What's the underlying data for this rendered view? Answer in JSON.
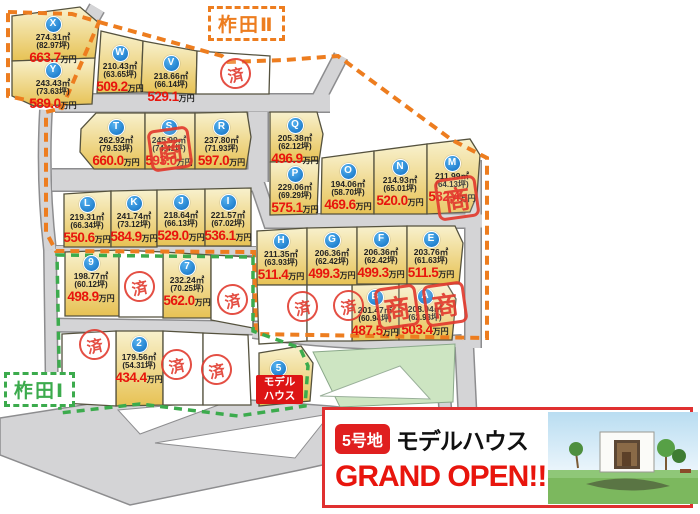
{
  "region_labels": {
    "kakita_2": "柞田Ⅱ",
    "kakita_1": "柞田Ⅰ"
  },
  "price_unit": "万円",
  "stamp_sold": "済",
  "stamp_deal": "商",
  "lots": [
    {
      "id": "X",
      "area": "274.31㎡",
      "tsubo": "(82.97坪)",
      "price": "663.7"
    },
    {
      "id": "Y",
      "area": "243.43㎡",
      "tsubo": "(73.63坪)",
      "price": "589.0"
    },
    {
      "id": "W",
      "area": "210.43㎡",
      "tsubo": "(63.65坪)",
      "price": "509.2"
    },
    {
      "id": "V",
      "area": "218.66㎡",
      "tsubo": "(66.14坪)",
      "price": "529.1"
    },
    {
      "id": "T",
      "area": "262.92㎡",
      "tsubo": "(79.53坪)",
      "price": "660.0"
    },
    {
      "id": "S",
      "area": "245.99㎡",
      "tsubo": "(74.41坪)",
      "price": "593.0"
    },
    {
      "id": "R",
      "area": "237.80㎡",
      "tsubo": "(71.93坪)",
      "price": "597.0"
    },
    {
      "id": "Q",
      "area": "205.38㎡",
      "tsubo": "(62.12坪)",
      "price": "496.9"
    },
    {
      "id": "P",
      "area": "229.06㎡",
      "tsubo": "(69.29坪)",
      "price": "575.1"
    },
    {
      "id": "O",
      "area": "194.06㎡",
      "tsubo": "(58.70坪)",
      "price": "469.6"
    },
    {
      "id": "N",
      "area": "214.93㎡",
      "tsubo": "(65.01坪)",
      "price": "520.0"
    },
    {
      "id": "M",
      "area": "211.99㎡",
      "tsubo": "(64.13坪)",
      "price": "532.4"
    },
    {
      "id": "L",
      "area": "219.31㎡",
      "tsubo": "(66.34坪)",
      "price": "550.6"
    },
    {
      "id": "K",
      "area": "241.74㎡",
      "tsubo": "(73.12坪)",
      "price": "584.9"
    },
    {
      "id": "J",
      "area": "218.64㎡",
      "tsubo": "(66.13坪)",
      "price": "529.0"
    },
    {
      "id": "I",
      "area": "221.57㎡",
      "tsubo": "(67.02坪)",
      "price": "536.1"
    },
    {
      "id": "H",
      "area": "211.35㎡",
      "tsubo": "(63.93坪)",
      "price": "511.4"
    },
    {
      "id": "G",
      "area": "206.36㎡",
      "tsubo": "(62.42坪)",
      "price": "499.3"
    },
    {
      "id": "F",
      "area": "206.36㎡",
      "tsubo": "(62.42坪)",
      "price": "499.3"
    },
    {
      "id": "E",
      "area": "203.76㎡",
      "tsubo": "(61.63坪)",
      "price": "511.5"
    },
    {
      "id": "B",
      "area": "201.47㎡",
      "tsubo": "(60.94坪)",
      "price": "487.5"
    },
    {
      "id": "A",
      "area": "208.04㎡",
      "tsubo": "(62.93坪)",
      "price": "503.4"
    },
    {
      "id": "9",
      "area": "198.77㎡",
      "tsubo": "(60.12坪)",
      "price": "498.9"
    },
    {
      "id": "7",
      "area": "232.24㎡",
      "tsubo": "(70.25坪)",
      "price": "562.0"
    },
    {
      "id": "2",
      "area": "179.56㎡",
      "tsubo": "(54.31坪)",
      "price": "434.4"
    }
  ],
  "model_house": {
    "circle": "5",
    "line1": "モデル",
    "line2": "ハウス"
  },
  "banner": {
    "badge": "5号地",
    "title": "モデルハウス",
    "headline": "GRAND OPEN!!"
  },
  "colors": {
    "boundary_orange": "#ed7d1f",
    "boundary_green": "#3cab4d",
    "price_red": "#e8150d",
    "stamp_red": "#e23c30",
    "lot_yellow": "#e9c75a",
    "road_gray": "#d4d4d6",
    "circle_blue": "#0e6ec2",
    "banner_red": "#e03030"
  }
}
